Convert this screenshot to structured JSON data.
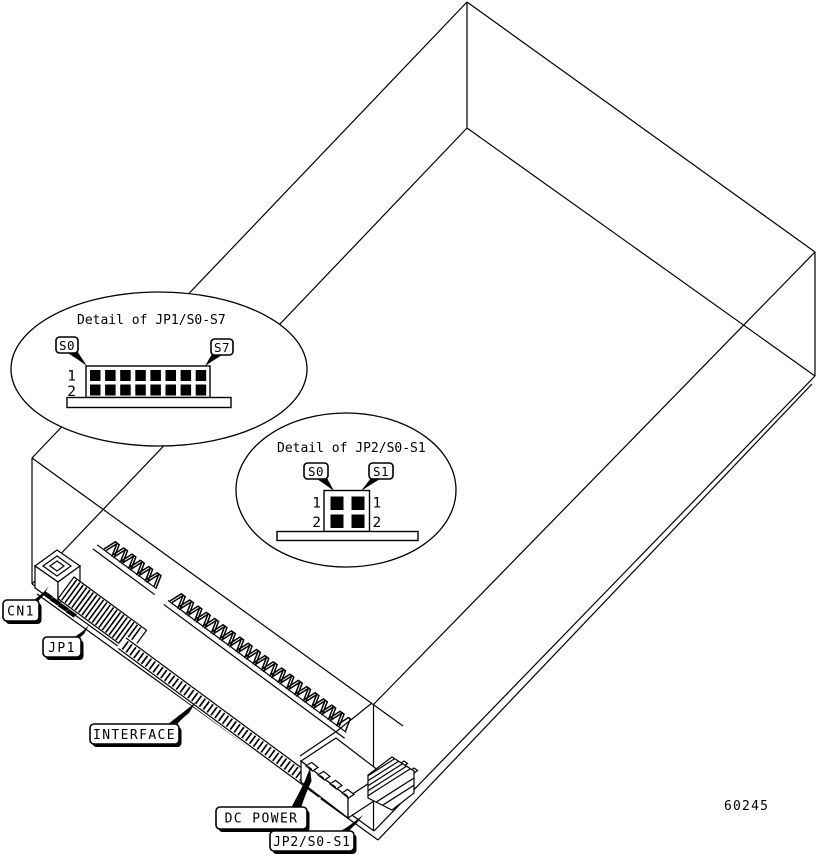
{
  "figure_number": "60245",
  "colors": {
    "line": "#000000",
    "background": "#ffffff"
  },
  "bubble_jp1": {
    "title": "Detail of JP1/S0-S7",
    "callout_left": "S0",
    "callout_right": "S7",
    "row1": "1",
    "row2": "2",
    "pin_rows": 2,
    "pin_cols": 8
  },
  "bubble_jp2": {
    "title": "Detail of JP2/S0-S1",
    "callout_left": "S0",
    "callout_right": "S1",
    "row1_left": "1",
    "row2_left": "2",
    "row1_right": "1",
    "row2_right": "2",
    "pin_rows": 2,
    "pin_cols": 2
  },
  "component_labels": {
    "cn1": "CN1",
    "jp1": "JP1",
    "interface": "INTERFACE",
    "dc_power": "DC POWER",
    "jp2": "JP2/S0-S1"
  }
}
